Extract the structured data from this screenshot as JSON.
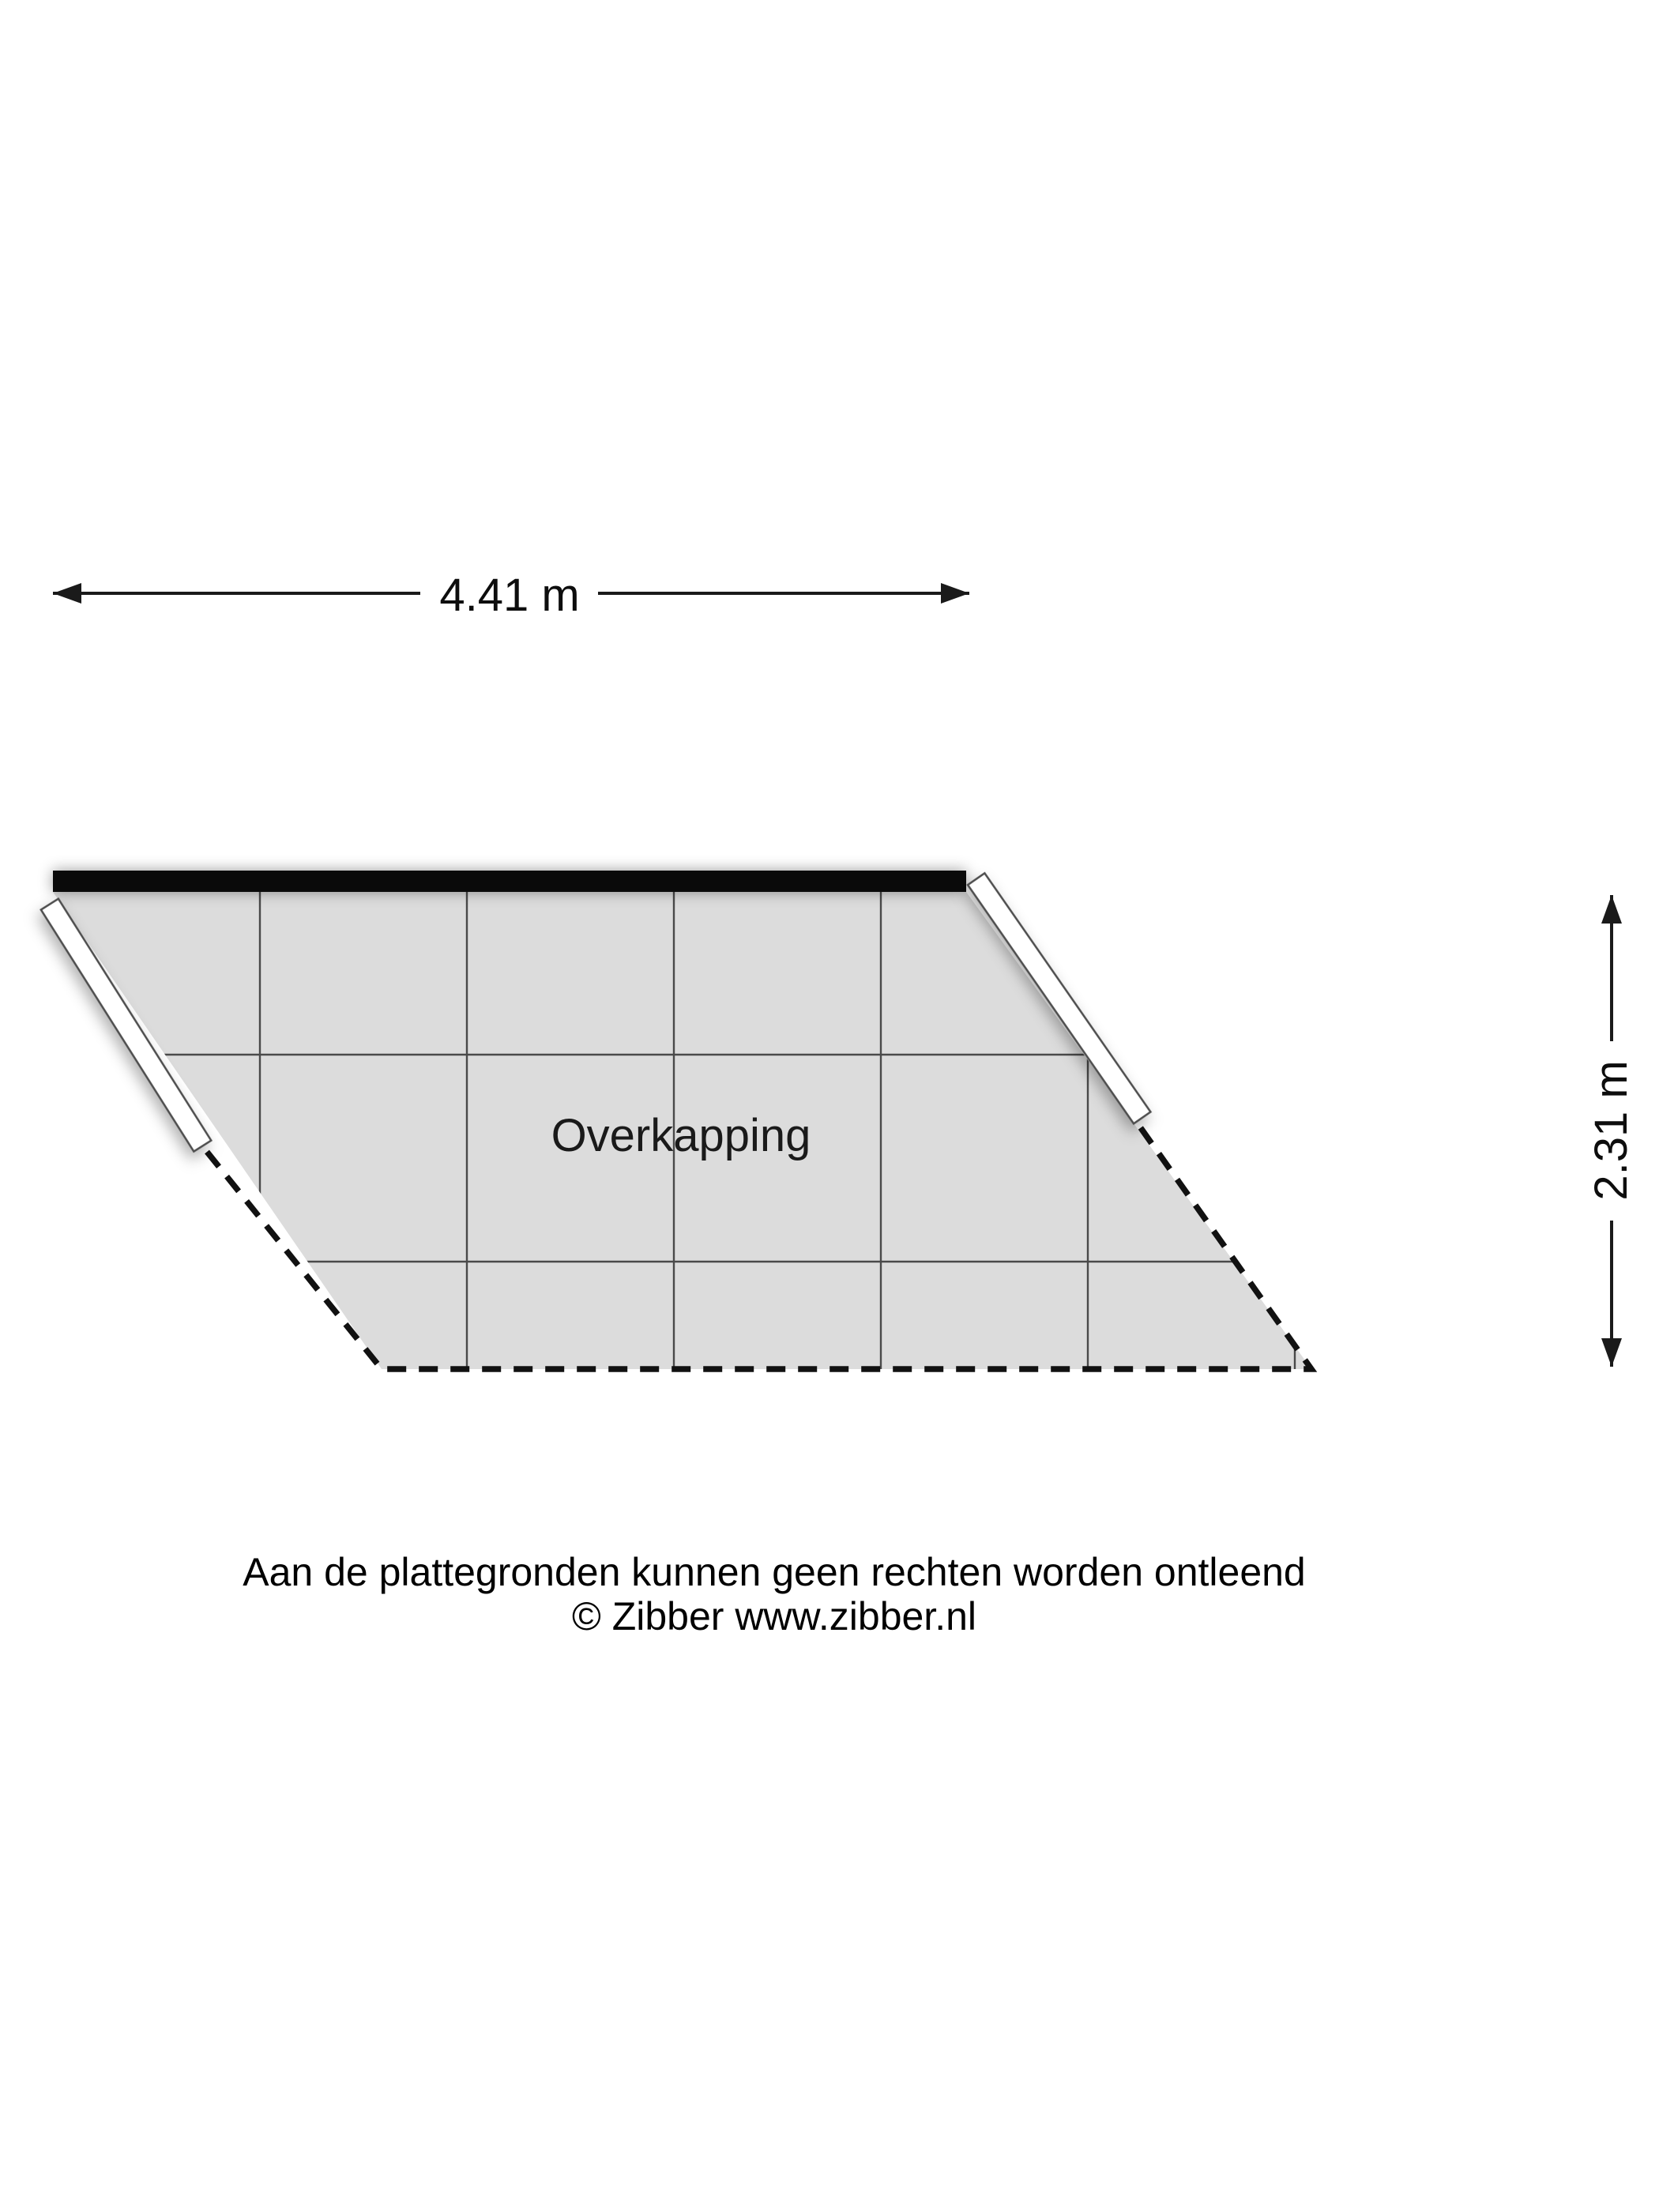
{
  "dimensions": {
    "width_label": "4.41 m",
    "height_label": "2.31 m"
  },
  "room": {
    "label": "Overkapping"
  },
  "footer": {
    "disclaimer": "Aan de plattegronden kunnen geen rechten worden ontleend",
    "copyright": "© Zibber www.zibber.nl"
  },
  "colors": {
    "floor_fill": "#dcdcdc",
    "grid_line": "#4a4a4a",
    "top_wall": "#0a0a0a",
    "side_wall_fill": "#ffffff",
    "side_wall_stroke": "#4d4d4d",
    "dashed_boundary": "#111111",
    "dimension_line": "#1a1a1a",
    "text": "#000000"
  }
}
